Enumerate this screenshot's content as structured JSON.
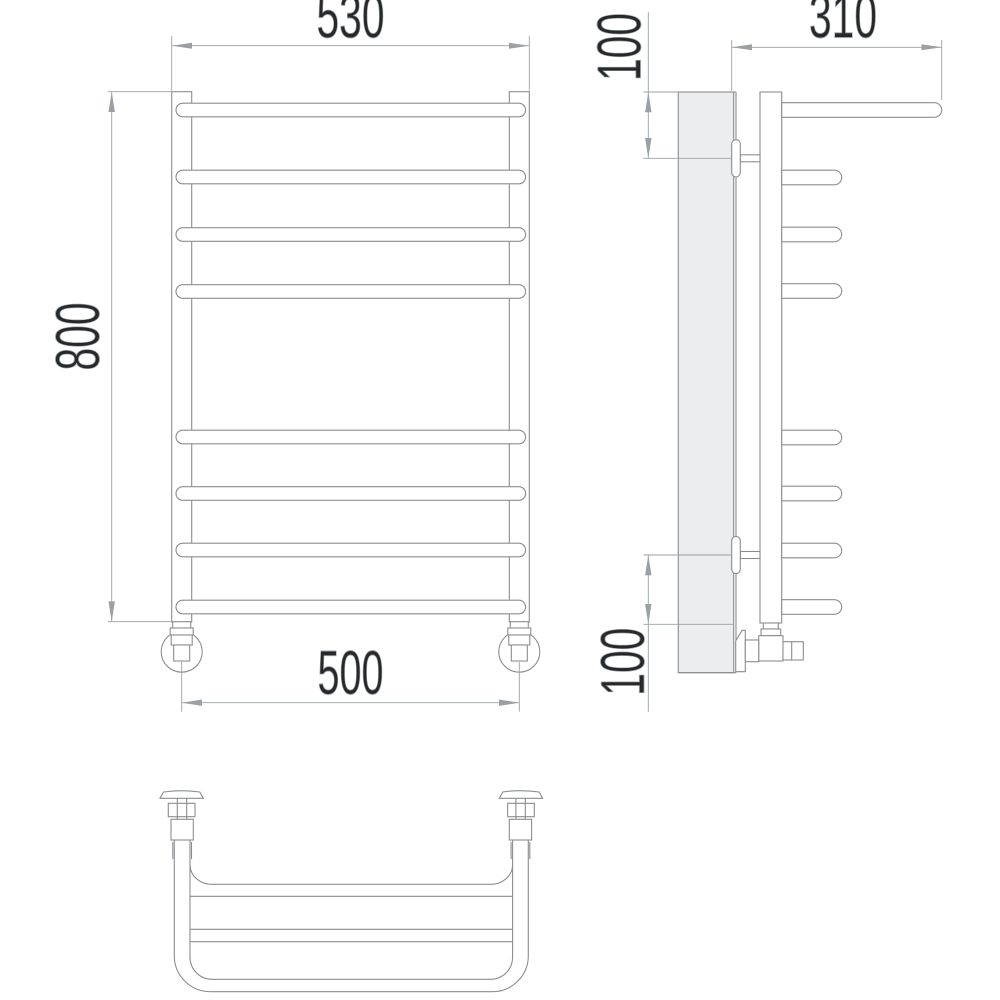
{
  "drawing": {
    "kind": "dimensioned line drawing",
    "bar_count_front": 8,
    "bar_count_side_short": 7
  },
  "dimensions": {
    "front_width_top": "530",
    "front_height": "800",
    "front_width_bottom": "500",
    "side_depth": "310",
    "side_offset_top": "100",
    "side_offset_bottom": "100"
  },
  "colors": {
    "outline": "#8a8e91",
    "dimension": "#9aa0a3",
    "text": "#26282a",
    "wall_fill": "#ebedee",
    "background": "#ffffff"
  }
}
